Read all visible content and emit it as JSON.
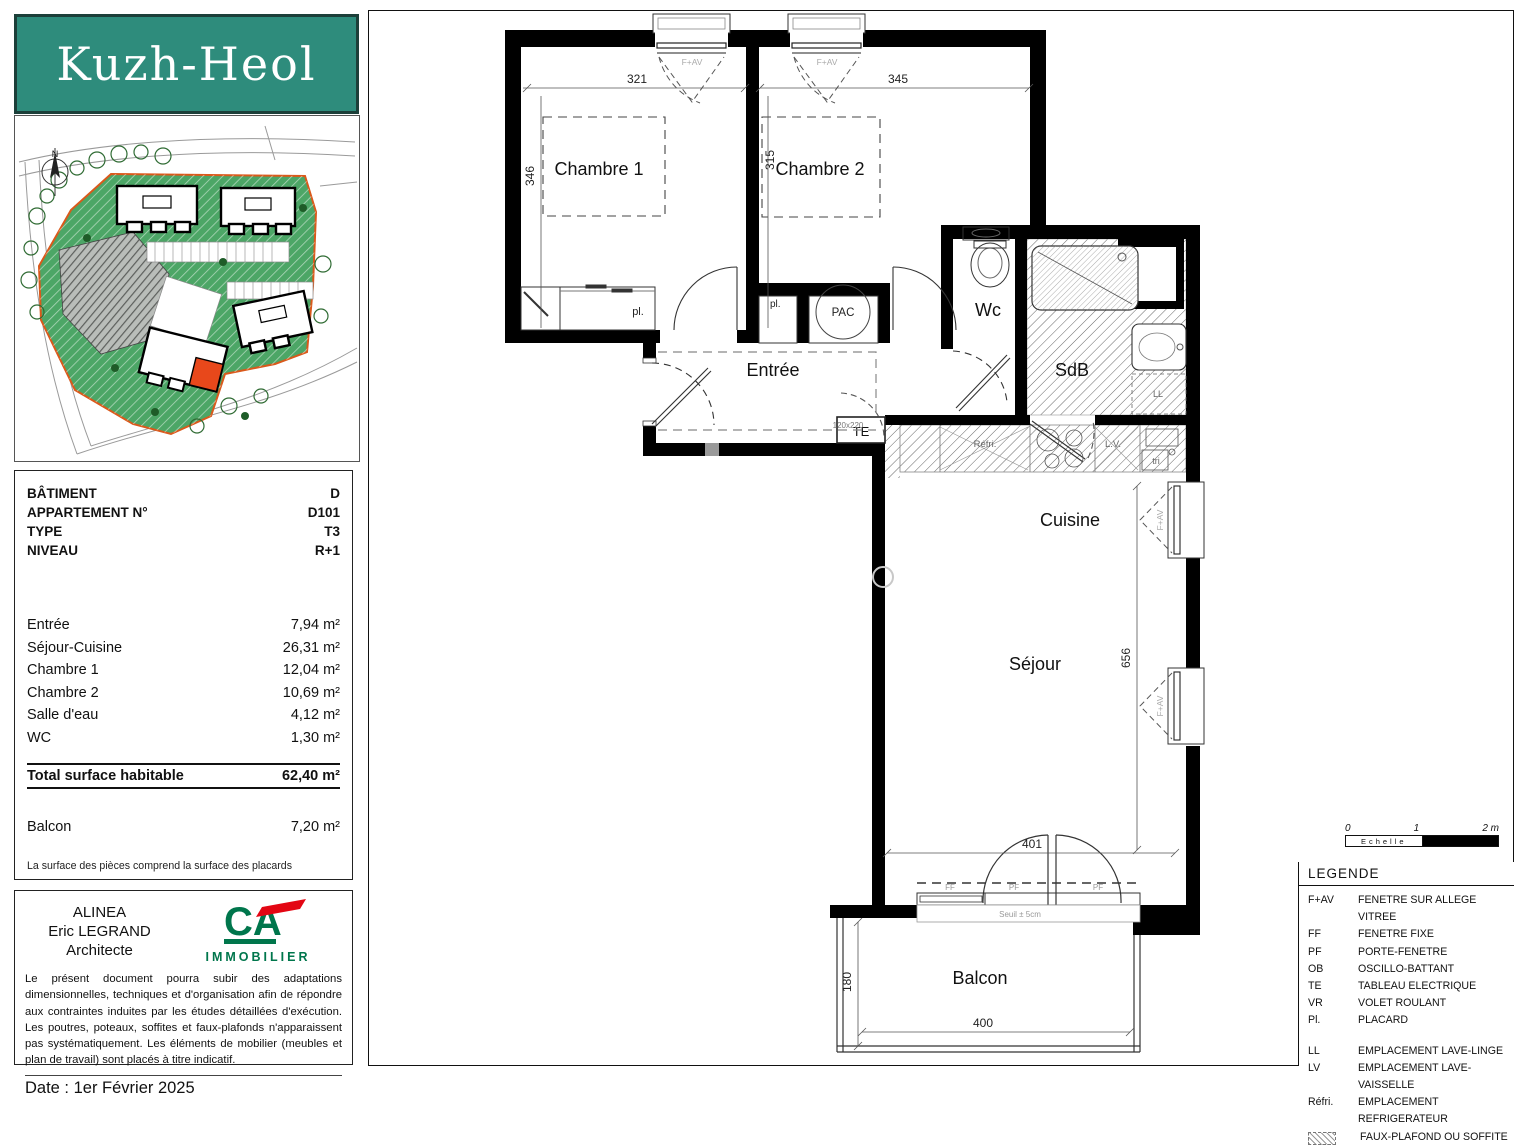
{
  "logo": {
    "brand": "Kuzh-Heol"
  },
  "site_plan": {
    "north": "N"
  },
  "info_panel": {
    "header_rows": [
      {
        "label": "BÂTIMENT",
        "value": "D"
      },
      {
        "label": "APPARTEMENT N°",
        "value": "D101"
      },
      {
        "label": "TYPE",
        "value": "T3"
      },
      {
        "label": "NIVEAU",
        "value": "R+1"
      }
    ],
    "area_rows": [
      {
        "label": "Entrée",
        "value": "7,94 m²"
      },
      {
        "label": "Séjour-Cuisine",
        "value": "26,31 m²"
      },
      {
        "label": "Chambre 1",
        "value": "12,04 m²"
      },
      {
        "label": "Chambre 2",
        "value": "10,69 m²"
      },
      {
        "label": "Salle d'eau",
        "value": "4,12 m²"
      },
      {
        "label": "WC",
        "value": "1,30 m²"
      }
    ],
    "total": {
      "label": "Total surface habitable",
      "value": "62,40 m²"
    },
    "balcony": {
      "label": "Balcon",
      "value": "7,20 m²"
    },
    "footnote": "La surface des pièces comprend la surface des placards"
  },
  "architect": {
    "firm": "ALINEA",
    "name": "Eric LEGRAND",
    "role": "Architecte",
    "logo_text": "CA",
    "logo_sub": "IMMOBILIER",
    "disclaimer": "Le présent document pourra subir des adaptations dimensionnelles, techniques et d'organisation afin de répondre aux contraintes induites par les études détaillées d'exécution. Les poutres, poteaux, soffites et faux-plafonds n'apparaissent pas systématiquement. Les éléments de mobilier (meubles et plan de travail) sont placés à titre indicatif.",
    "date": "Date : 1er Février 2025"
  },
  "plan": {
    "rooms": {
      "chambre1": "Chambre 1",
      "chambre2": "Chambre 2",
      "entree": "Entrée",
      "wc": "Wc",
      "sdb": "SdB",
      "cuisine": "Cuisine",
      "sejour": "Séjour",
      "balcon": "Balcon"
    },
    "labels": {
      "pac": "PAC",
      "te": "TE",
      "pl": "pl.",
      "ll": "LL",
      "lv": "L.V.",
      "refri": "Réfri.",
      "tri": "tri",
      "fav": "F+AV",
      "ff": "FF",
      "pf": "PF",
      "door_size": "120x220",
      "seuil": "Seuil ± 5cm"
    },
    "dims": {
      "ch1_w": "321",
      "ch1_h": "346",
      "ch2_w": "345",
      "ch2_h": "315",
      "sejour_h": "656",
      "sejour_w": "401",
      "balcon_h": "180",
      "balcon_w": "400"
    }
  },
  "scale_bar": {
    "t0": "0",
    "t1": "1",
    "t2": "2 m",
    "label": "Echelle"
  },
  "legend": {
    "title": "LEGENDE",
    "items": [
      {
        "code": "F+AV",
        "label": "FENETRE SUR ALLEGE VITREE"
      },
      {
        "code": "FF",
        "label": "FENETRE FIXE"
      },
      {
        "code": "PF",
        "label": "PORTE-FENETRE"
      },
      {
        "code": "OB",
        "label": "OSCILLO-BATTANT"
      },
      {
        "code": "TE",
        "label": "TABLEAU ELECTRIQUE"
      },
      {
        "code": "VR",
        "label": "VOLET ROULANT"
      },
      {
        "code": "Pl.",
        "label": "PLACARD"
      }
    ],
    "items2": [
      {
        "code": "LL",
        "label": "EMPLACEMENT LAVE-LINGE"
      },
      {
        "code": "LV",
        "label": "EMPLACEMENT LAVE-VAISSELLE"
      },
      {
        "code": "Réfri.",
        "label": "EMPLACEMENT REFRIGERATEUR"
      }
    ],
    "hatch_label": "FAUX-PLAFOND OU SOFFITE"
  },
  "colors": {
    "brand_teal": "#2E8C7C",
    "site_green": "#4CA666",
    "boundary_orange": "#D9591B",
    "unit_red": "#E8481B",
    "ca_green": "#00764C",
    "ca_red": "#E30613"
  }
}
